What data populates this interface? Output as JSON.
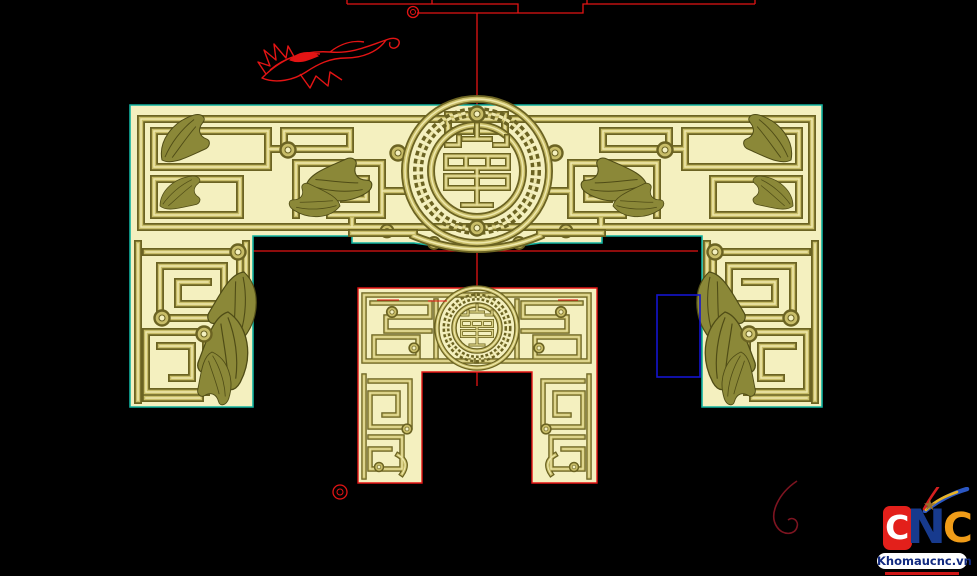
{
  "colors": {
    "bg": "#000000",
    "panel_fill": "#f4f0bf",
    "relief_dark": "#6b6322",
    "relief_mid": "#c8bd68",
    "relief_light": "#efe9ac",
    "leaf_dark": "#4f4c16",
    "leaf_mid": "#8b8838",
    "outline_teal": "#12b2a0",
    "wire_red": "#e31414",
    "swirl_dark": "#7d1420",
    "select_blue": "#1414cf",
    "logo_red": "#e3201b",
    "logo_blue": "#173a8d",
    "logo_orange": "#f09c18",
    "logo_star": "#96712c",
    "banner_bg": "#ffffff",
    "banner_text": "#122a80",
    "underline_red": "#cf1616"
  },
  "logo": {
    "letter_1": "C",
    "letter_2": "N",
    "letter_3": "C",
    "site": "Khomaucnc.vn",
    "star_icon": "★"
  },
  "scene": {
    "background": "#000000",
    "entities": [
      {
        "name": "construction-wireframe",
        "color_ref": "wire_red"
      },
      {
        "name": "floral-ornament-wireframe",
        "color_ref": "wire_red"
      },
      {
        "name": "main-carved-panel",
        "color_ref": "panel_fill"
      },
      {
        "name": "small-carved-panel",
        "color_ref": "panel_fill"
      },
      {
        "name": "selection-rectangle",
        "color_ref": "select_blue"
      },
      {
        "name": "marker-circle",
        "color_ref": "wire_red"
      },
      {
        "name": "swirl-curve",
        "color_ref": "swirl_dark"
      },
      {
        "name": "watermark-logo"
      }
    ]
  }
}
